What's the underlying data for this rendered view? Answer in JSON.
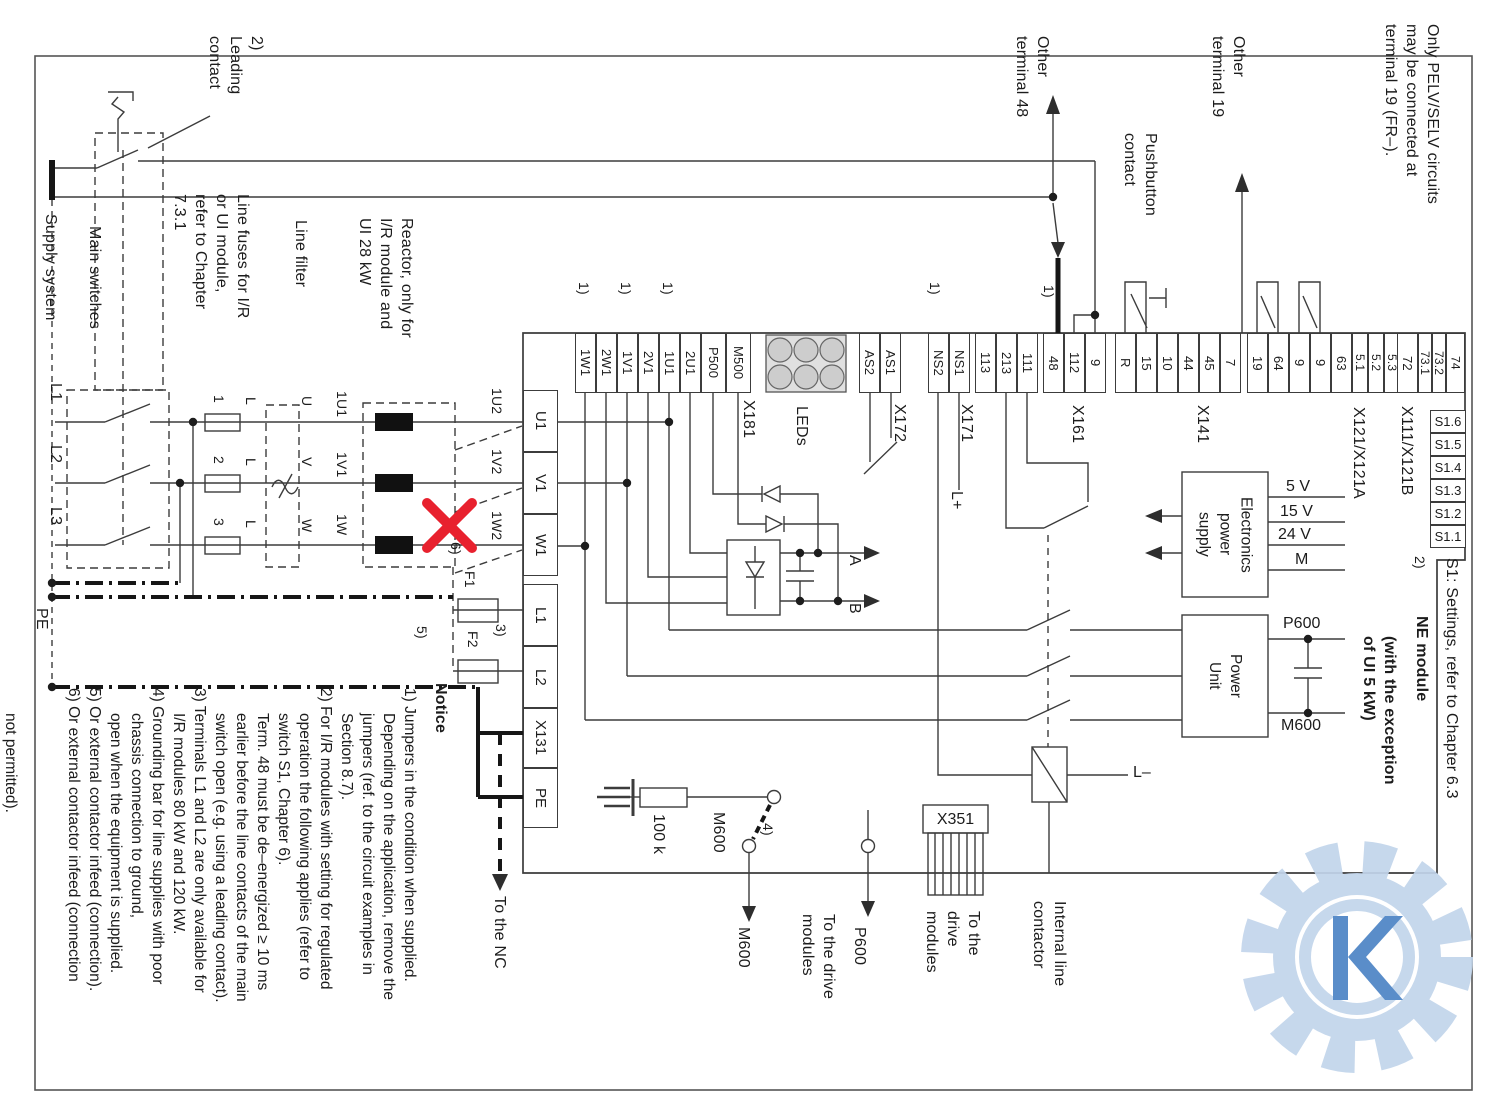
{
  "texts": {
    "pelv_note": "Only PELV/SELV circuits\nmay be connected at\nterminal 19 (FR–).",
    "other_terminal_48": "Other\nterminal 48",
    "other_terminal_19": "Other\nterminal 19",
    "pushbutton_contact": "Pushbutton\ncontact",
    "leading_contact": "2)\nLeading\ncontact",
    "supply_system": "Supply system",
    "main_switches": "Main switches",
    "fuse_note": "Line fuses for I/R\nor UI module,\nrefer to Chapter\n7.3.1",
    "line_filter": "Line filter",
    "reactor_note": "Reactor, only for\nI/R module and\nUI 28 kW",
    "phase_l1": "L1",
    "phase_l2": "L2",
    "phase_l3": "L3",
    "pe": "PE",
    "fuse_1": "1",
    "fuse_2": "2",
    "fuse_3": "3",
    "l_mark": "L",
    "u": "U",
    "v": "V",
    "w": "W",
    "r1u1": "1U1",
    "r1v1": "1V1",
    "r1w": "1W",
    "m1u2": "1U2",
    "m1v2": "1V2",
    "m1w2": "1W2",
    "note6_ref": "6)",
    "f1": "F1",
    "note5_ref": "5)",
    "f2": "F2",
    "note3_ref": "3)",
    "jumper_ref": "1)",
    "a": "A",
    "b": "B",
    "l_plus": "L+",
    "l_minus": "L–",
    "res_100k": "100 k",
    "m600_internal": "M600",
    "note4_ref": "4)",
    "m600_below": "M600",
    "p600_below": "P600",
    "to_the_nc": "To the NC",
    "to_drive_modules_2": "To the drive\nmodules",
    "to_drive_modules_3": "To the\ndrive\nmodules",
    "x351": "X351",
    "internal_line_contactor": "Internal line\ncontactor",
    "eps": "Electronics\npower\nsupply",
    "power_unit": "Power\nUnit",
    "v5": "5 V",
    "v15": "15 V",
    "v24": "24 V",
    "m_out": "M",
    "p600_cap": "P600",
    "m600_cap": "M600",
    "s1_note_ref": "2)",
    "s1_settings": "S1: Settings, refer to Chapter 6.3",
    "ne_module": "NE module",
    "ne_module_exception": "(with the exception\nof UI 5 kW)"
  },
  "terminal_groups": [
    {
      "id": "x181",
      "label": "X181",
      "pins": [
        "1W1",
        "2W1",
        "1V1",
        "2V1",
        "1U1",
        "2U1",
        "P500",
        "M500"
      ]
    },
    {
      "id": "leds",
      "label": "LEDs",
      "pins": []
    },
    {
      "id": "x172",
      "label": "X172",
      "pins": [
        "AS2",
        "AS1"
      ]
    },
    {
      "id": "x171",
      "label": "X171",
      "pins": [
        "NS2",
        "NS1"
      ]
    },
    {
      "id": "x161",
      "label": "X161",
      "pins": [
        "113",
        "213",
        "111",
        "48",
        "112",
        "9"
      ]
    },
    {
      "id": "x141",
      "label": "X141",
      "pins": [
        "R",
        "15",
        "10",
        "44",
        "45",
        "7"
      ]
    },
    {
      "id": "x121",
      "label": "X121/X121A",
      "pins": [
        "19",
        "64",
        "9",
        "9",
        "63",
        "5.1",
        "5.2",
        "5.3"
      ]
    },
    {
      "id": "x111",
      "label": "X111/X121B",
      "pins": [
        "72",
        "73.1",
        "73.2",
        "74"
      ]
    }
  ],
  "left_terminals": [
    "U1",
    "V1",
    "W1",
    "L1",
    "L2",
    "X131",
    "PE"
  ],
  "s1_switches": [
    "S1.6",
    "S1.5",
    "S1.4",
    "S1.3",
    "S1.2",
    "S1.1"
  ],
  "notice": {
    "heading": "Notice",
    "lines": [
      {
        "text": "1) Jumpers in the condition when supplied.",
        "cont": false
      },
      {
        "text": "Depending on the application, remove the",
        "cont": true
      },
      {
        "text": "jumpers (ref. to the circuit examples in",
        "cont": true
      },
      {
        "text": "Section 8.7).",
        "cont": true
      },
      {
        "text": "2) For I/R modules with setting for regulated",
        "cont": false
      },
      {
        "text": "operation the following applies (refer to",
        "cont": true
      },
      {
        "text": "switch S1, Chapter 6).",
        "cont": true
      },
      {
        "text": "Term. 48 must be de–energized ≥  10 ms",
        "cont": true
      },
      {
        "text": "earlier before the line contacts of the main",
        "cont": true
      },
      {
        "text": "switch open (e.g. using a leading contact).",
        "cont": true
      },
      {
        "text": "3) Terminals L1 and L2 are only available for",
        "cont": false
      },
      {
        "text": "I/R modules 80 kW and 120 kW.",
        "cont": true
      },
      {
        "text": "4) Grounding bar for line supplies with poor",
        "cont": false
      },
      {
        "text": "chassis connection to ground,",
        "cont": true
      },
      {
        "text": "open when the equipment is supplied.",
        "cont": true
      },
      {
        "text": "5) Or external contactor infeed (connection).",
        "cont": false
      },
      {
        "text": "6) Or external contactor infeed (connection",
        "cont": false
      },
      {
        "text": "not permitted).",
        "cont": true
      }
    ]
  }
}
